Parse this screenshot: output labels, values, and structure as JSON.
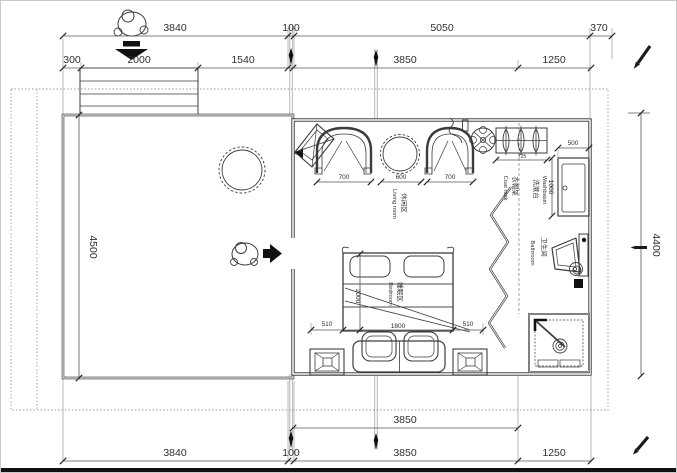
{
  "colors": {
    "background": "#ffffff",
    "line": "#3c3c3c",
    "text": "#2f2f2f",
    "boundary": "#9a9a9a",
    "accent_black": "#111111"
  },
  "labels": {
    "living": {
      "zh": "休闲区",
      "en": "Living room"
    },
    "coat_rack": {
      "zh": "衣帽架",
      "en": "Coat rack"
    },
    "washbasin": {
      "zh": "洗漱台",
      "en": "Washbasin"
    },
    "bathroom": {
      "zh": "卫生间",
      "en": "Bathroom"
    },
    "bedroom": {
      "zh": "睡眠区",
      "en": "Bedroom"
    }
  },
  "dims": {
    "top_outer": [
      "3840",
      "100",
      "5050",
      "370"
    ],
    "top_inner": [
      "300",
      "2000",
      "1540",
      "3850",
      "1250"
    ],
    "left": "4500",
    "right": "4400",
    "living": [
      "700",
      "600",
      "700"
    ],
    "coat_rack": "725",
    "washbasin_width": "500",
    "washbasin_depth": "1000",
    "bed_row": [
      "510",
      "1800",
      "510"
    ],
    "bed_length": "2000",
    "bottom_inner": "3850",
    "bottom_outer": [
      "3840",
      "100",
      "3850",
      "1250"
    ]
  },
  "icons": {
    "person_top": "person-top-view",
    "entry_arrow_down": "arrow-down",
    "entry_arrow_right": "arrow-right",
    "ceiling_fan": "ceiling-fan",
    "pencil": "pencil-annotation",
    "section_marker": "section-cut-marker"
  }
}
